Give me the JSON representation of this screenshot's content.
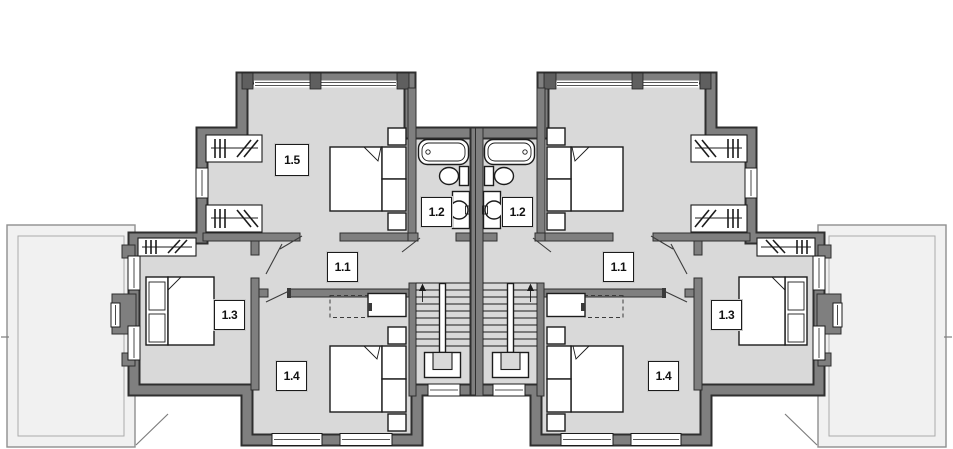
{
  "plan": {
    "type": "architectural-floor-plan",
    "description_visible_text_only": true,
    "rooms": [
      {
        "id": "left-bedroom-top",
        "label": "1.5"
      },
      {
        "id": "left-bathroom",
        "label": "1.2"
      },
      {
        "id": "right-bathroom",
        "label": "1.2"
      },
      {
        "id": "left-hallway",
        "label": "1.1"
      },
      {
        "id": "right-hallway",
        "label": "1.1"
      },
      {
        "id": "left-bedroom-side",
        "label": "1.3"
      },
      {
        "id": "right-bedroom-side",
        "label": "1.3"
      },
      {
        "id": "left-bedroom-bottom",
        "label": "1.4"
      },
      {
        "id": "right-bedroom-bottom",
        "label": "1.4"
      }
    ],
    "colors": {
      "floor": "#d9d9d9",
      "wall": "#7f7f7f",
      "wall_edge": "#2f2f2f",
      "terrace": "#f1f1f1"
    }
  }
}
